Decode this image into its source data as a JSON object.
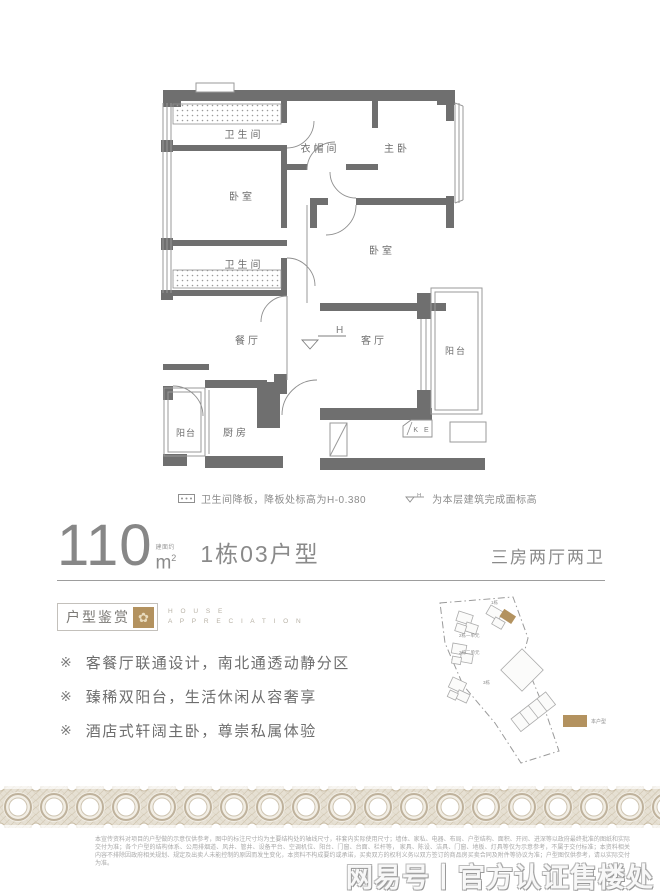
{
  "floorplan": {
    "rooms": {
      "bath1": "卫生间",
      "bed_left": "卧室",
      "bath2": "卫生间",
      "cloak": "衣帽间",
      "master": "主卧",
      "bed_right": "卧室",
      "dining": "餐厅",
      "living": "客厅",
      "balcony_right": "阳台",
      "balcony_left": "阳台",
      "kitchen": "厨房",
      "ac_box": "K E",
      "h_marker": "H"
    },
    "legend": {
      "drop_text": "卫生间降板，降板处标高为H-0.380",
      "h_symbol": "H",
      "h_text": "为本层建筑完成面标高"
    }
  },
  "title": {
    "area_number": "110",
    "area_note": "建面约",
    "area_unit": "m",
    "area_sup": "2",
    "unit_name": "1栋03户型",
    "layout_desc": "三房两厅两卫"
  },
  "appreciation": {
    "box_label": "户型鉴赏",
    "ornament_glyph": "✿",
    "en_line1": "H O U S E",
    "en_line2": "A P P R E C I A T I O N",
    "bullets": [
      {
        "marker": "※",
        "text": "客餐厅联通设计，南北通透动静分区"
      },
      {
        "marker": "※",
        "text": "臻稀双阳台，生活休闲从容奢享"
      },
      {
        "marker": "※",
        "text": "酒店式轩阔主卧，尊崇私属体验"
      }
    ]
  },
  "siteplan": {
    "labels": {
      "b1": "1栋",
      "b2u1": "2栋一单元",
      "b2u2": "2栋二单元",
      "b3": "3栋"
    },
    "legend_label": "本户型",
    "highlight_color": "#b3925f"
  },
  "footer": {
    "disclaimer_line1": "本宣传资料对项目的户型做的示意仅供参考，图中的标注尺寸均为主要结构处的轴线尺寸，非套内实际使用尺寸；墙体、家私、电器、布局、户型结构、面积、开间、进深等以政府最终批准的图纸和实际交付为准；各个户型的结构体系、公用排烟道、风井、管井、设备平台、空调机位、阳台、门窗、台面、栏杆等，",
    "disclaimer_line2": "家具、陈设、洁具、门窗、地板、灯具等仅为示意参考，不属于交付标准；本资料相关内容不排除因政府相关规划、规定及出卖人未能控制的原因而发生变化，本资料不构成要约或承诺，买卖双方的权利义务以双方签订的商品房买卖合同及附件等协议为准；户型图仅供参考，请以实际交付为准。",
    "watermark": "网易号丨官方认证售楼处"
  },
  "colors": {
    "wall_gray": "#6f6f6f",
    "line_gray": "#8f8f8f",
    "accent_tan": "#b3925f",
    "band_beige": "#cfc5b2"
  }
}
